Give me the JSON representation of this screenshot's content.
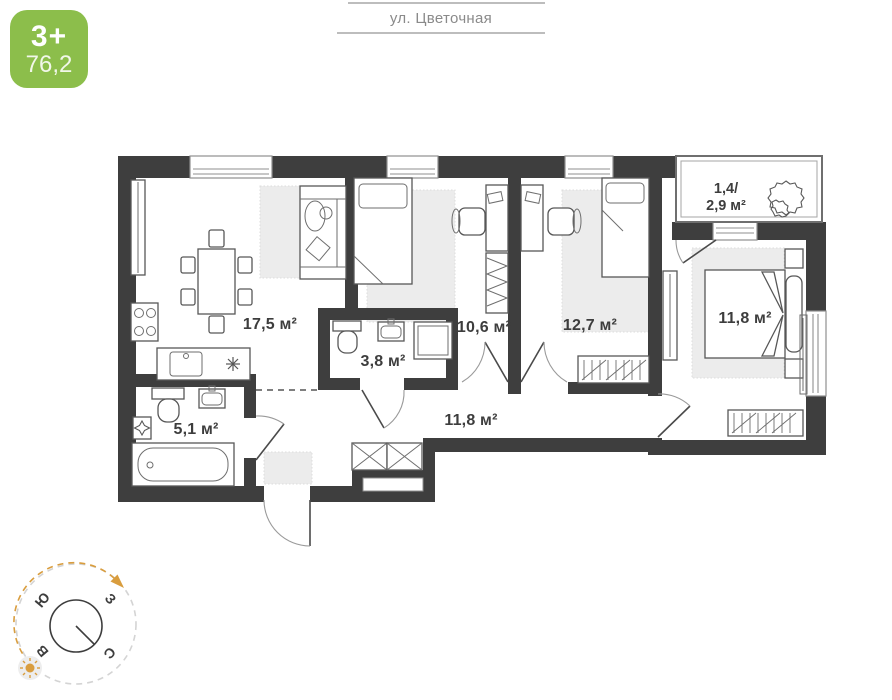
{
  "badge": {
    "type_label": "3+",
    "total_area": "76,2",
    "color": "#8cbe4b"
  },
  "street": {
    "label": "ул. Цветочная"
  },
  "plan": {
    "rooms": {
      "kitchen_living": {
        "name": "kitchen-living-room",
        "area_label": "17,5 м²"
      },
      "bedroom_small": {
        "name": "bedroom-small",
        "area_label": "10,6 м²"
      },
      "bedroom_middle": {
        "name": "bedroom-middle",
        "area_label": "12,7 м²"
      },
      "bedroom_master": {
        "name": "bedroom-master",
        "area_label": "11,8 м²"
      },
      "bathroom_small": {
        "name": "bathroom-small",
        "area_label": "3,8 м²"
      },
      "bathroom_large": {
        "name": "bathroom-large",
        "area_label": "5,1 м²"
      },
      "hallway": {
        "name": "hallway",
        "area_label": "11,8 м²"
      },
      "balcony": {
        "name": "balcony",
        "area_label_line1": "1,4/",
        "area_label_line2": "2,9 м²"
      }
    },
    "colors": {
      "wall": "#3e3e3e",
      "rug": "#ececec",
      "accent_green": "#8cbe4b",
      "compass_orange": "#d99d3e"
    }
  },
  "compass": {
    "north": "С",
    "south": "Ю",
    "west": "З",
    "east": "В"
  }
}
